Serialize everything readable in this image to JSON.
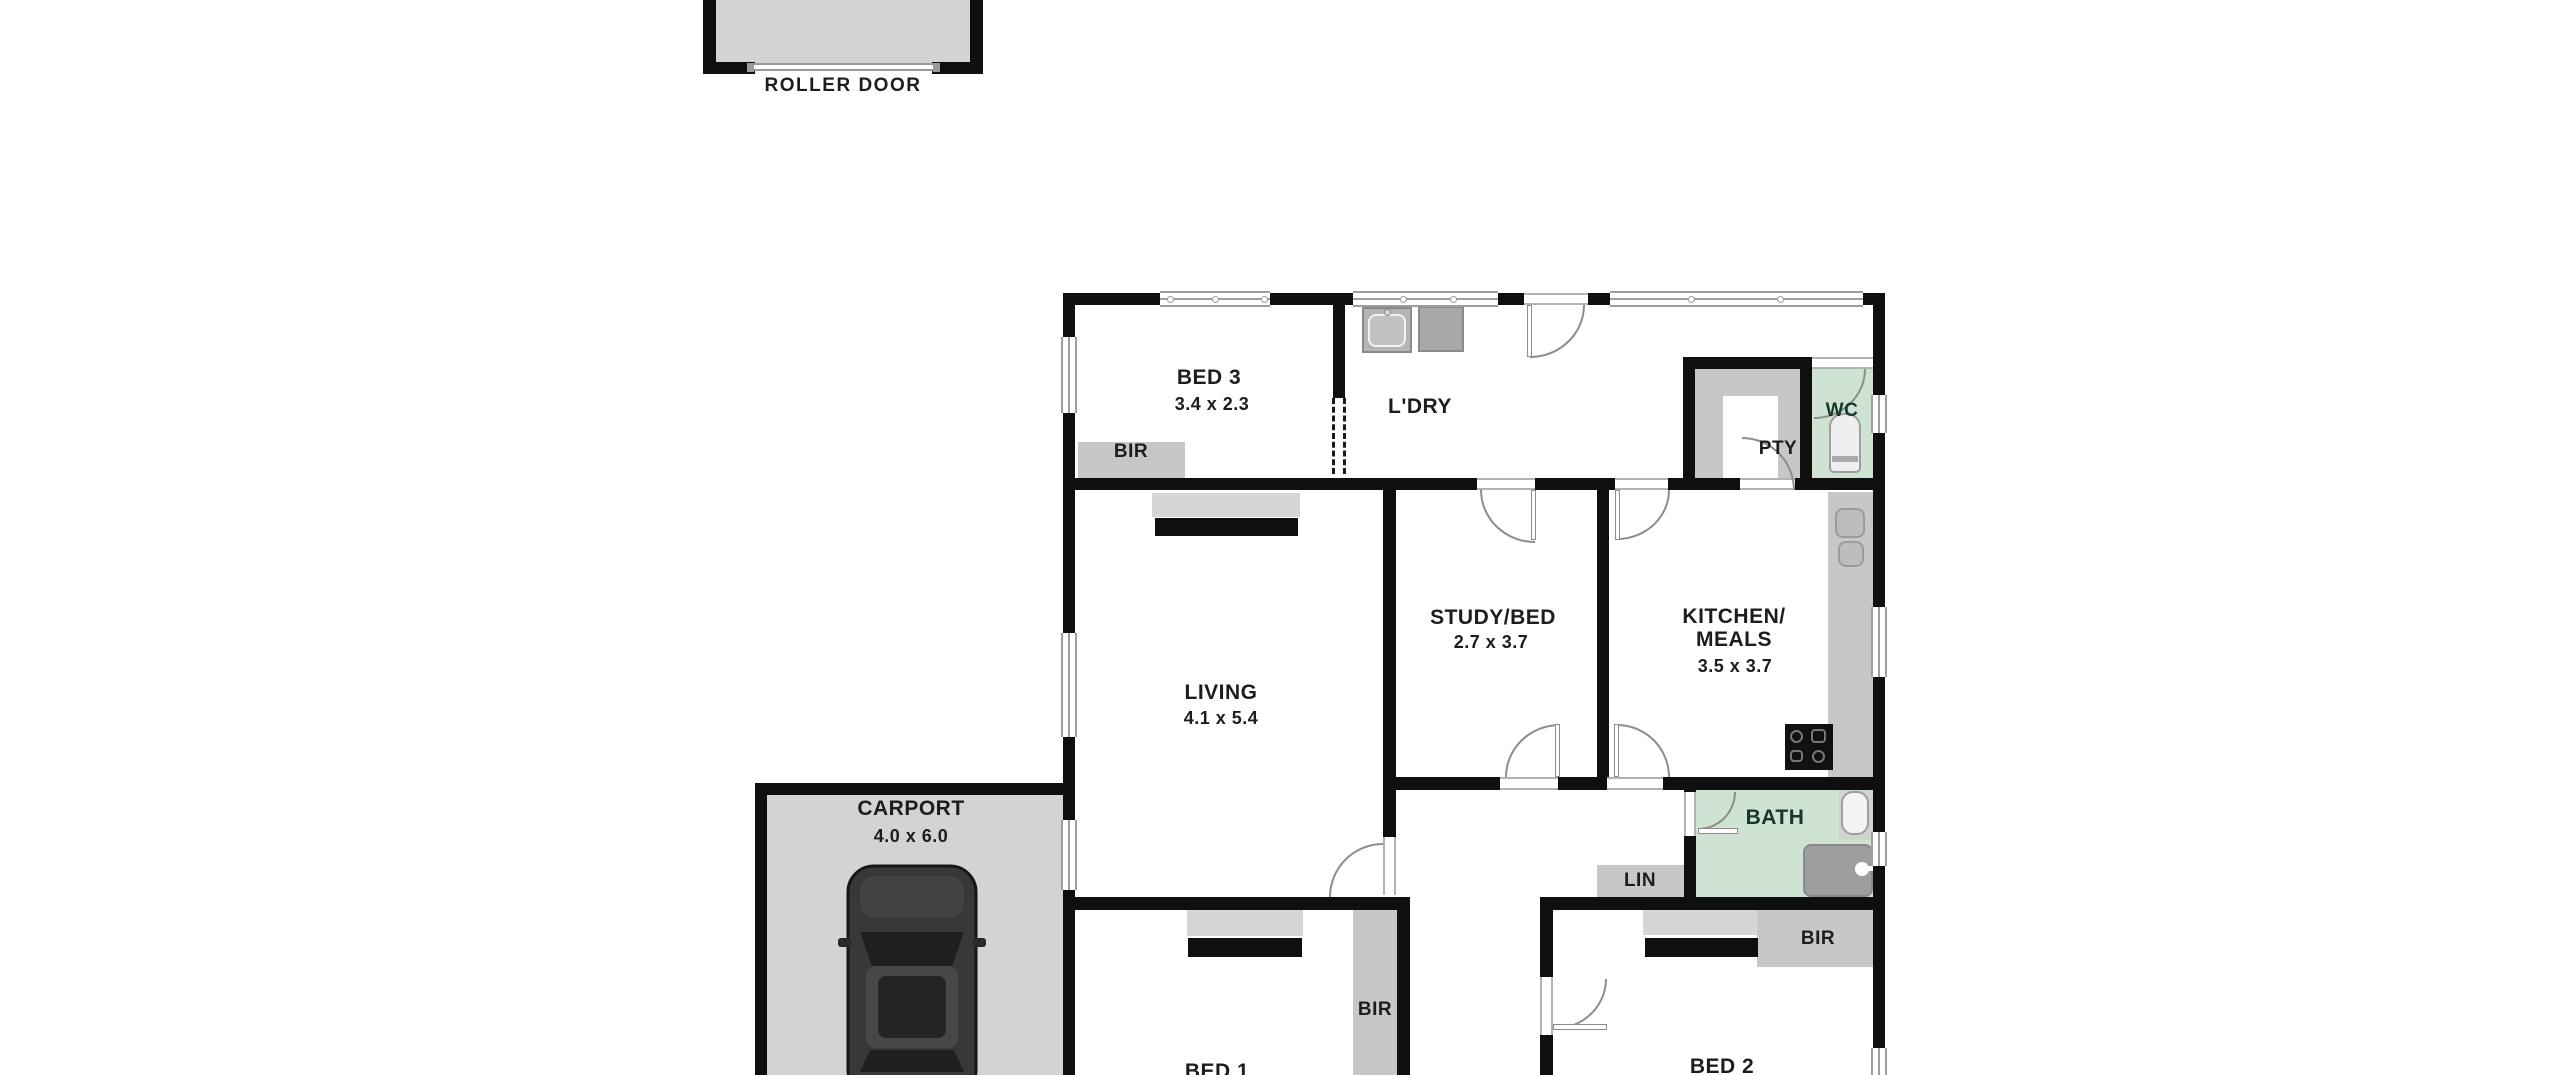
{
  "plan": {
    "roller_door": {
      "label": "ROLLER DOOR"
    },
    "carport": {
      "name": "CARPORT",
      "dims": "4.0 x 6.0"
    },
    "bed3": {
      "name": "BED 3",
      "dims": "3.4 x 2.3"
    },
    "ldry": {
      "name": "L'DRY"
    },
    "wc": {
      "name": "WC"
    },
    "pty": {
      "name": "PTY"
    },
    "living": {
      "name": "LIVING",
      "dims": "4.1 x 5.4"
    },
    "study": {
      "name": "STUDY/BED",
      "dims": "2.7 x 3.7"
    },
    "kitchen": {
      "line1": "KITCHEN/",
      "line2": "MEALS",
      "dims": "3.5 x 3.7"
    },
    "bath": {
      "name": "BATH"
    },
    "lin": {
      "name": "LIN"
    },
    "bed1": {
      "name": "BED 1"
    },
    "bed2": {
      "name": "BED 2"
    },
    "closets": {
      "bir_bed3": "BIR",
      "bir_bed1": "BIR",
      "bir_bed2": "BIR"
    },
    "colors": {
      "wall": "#0f0f0f",
      "wet_area": "#cfe3d3",
      "paved": "#d3d3d3",
      "joinery": "#c7c7c7",
      "label": "#1d1d1d"
    }
  }
}
